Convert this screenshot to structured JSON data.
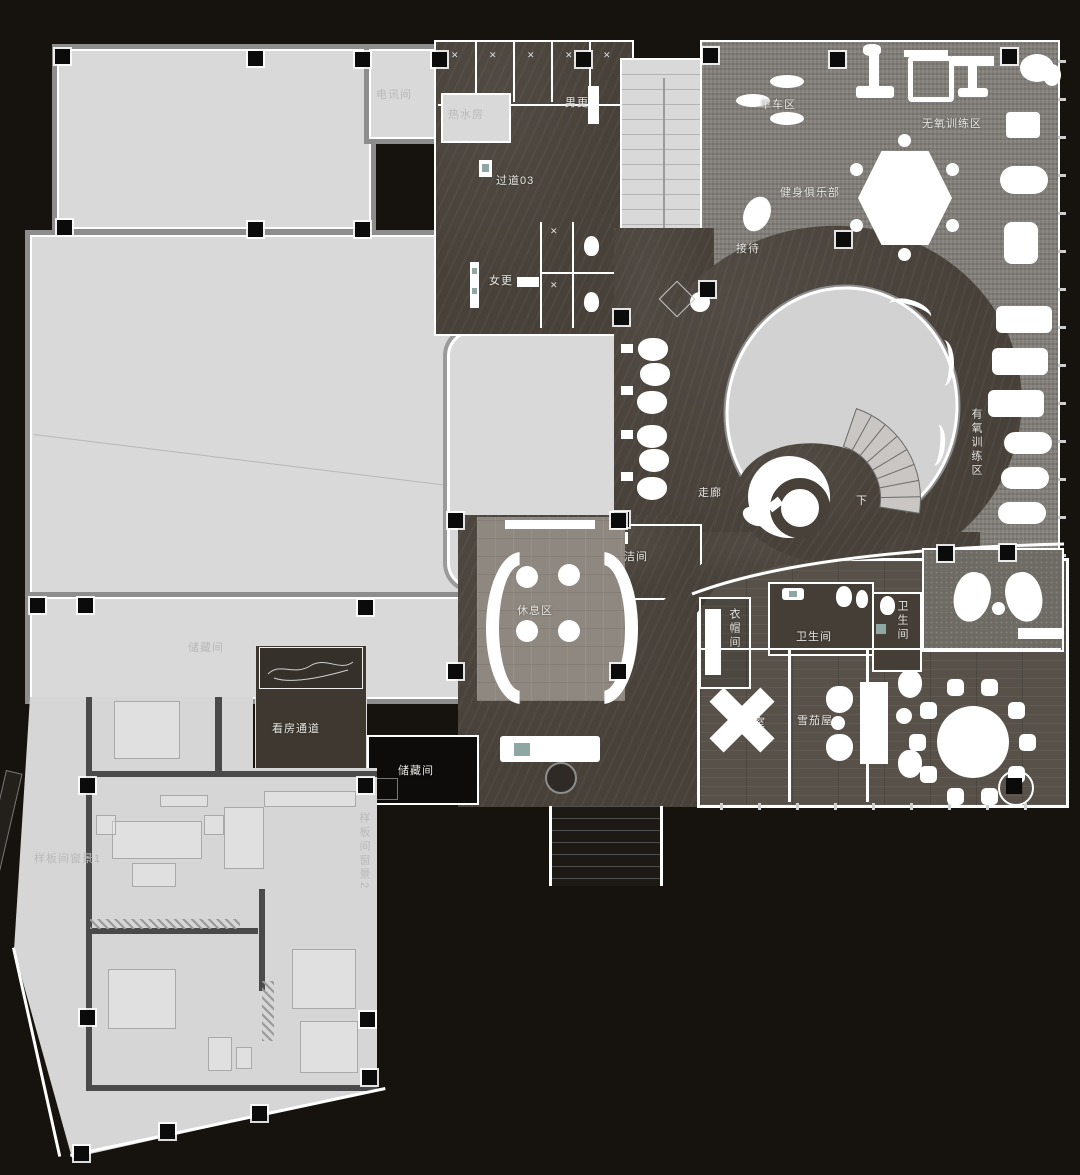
{
  "title": "健身俱乐部平面布置图",
  "labels": {
    "telecom": "电讯间",
    "hot_water": "热水房",
    "mens_change": "男更",
    "corridor03": "过道03",
    "womens_change": "女更",
    "bike_zone": "单车区",
    "anaerobic_zone": "无氧训练区",
    "fitness_club": "健身俱乐部",
    "reception": "接待",
    "aerobic_zone": "有氧训练区",
    "corridor": "走廊",
    "down": "下",
    "cleaning_room": "保洁间",
    "rest_area": "休息区",
    "storage_left": "储藏间",
    "viewing_passage": "看房通道",
    "storage_dark": "储藏间",
    "cloakroom": "衣帽间",
    "toilet_main": "卫生间",
    "toilet_small": "卫生间",
    "chess_room": "棋牌室",
    "cigar_room": "雪茄屋",
    "model_view1": "样板间窗景1",
    "model_view2": "样板间窗景2"
  },
  "colors": {
    "background": "#16120e",
    "light_room": "#d9d9d9",
    "dark_floor": "#48413a",
    "gym_carpet": "#817e79",
    "wood_floor": "#58514a",
    "wall": "#ffffff",
    "column": "#0b0b0b",
    "accent_teal": "#8fa7a3"
  },
  "counts": {
    "dining_chairs": 10,
    "booth_seats": 6,
    "treadmills": 3,
    "ellipticals": 3,
    "shower_stalls": 5
  }
}
